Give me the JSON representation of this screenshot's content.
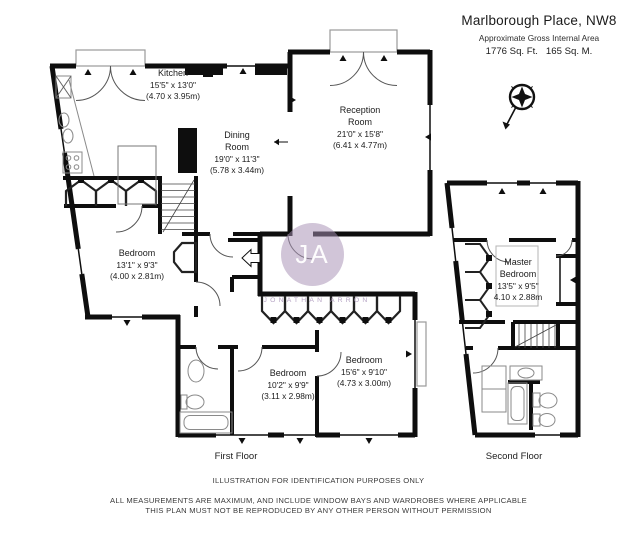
{
  "header": {
    "title": "Marlborough Place, NW8",
    "subtitle": "Approximate Gross Internal Area",
    "area": "1776 Sq. Ft.   165 Sq. M."
  },
  "compass": {
    "icon": "compass-rose"
  },
  "watermark": {
    "initials": "JA",
    "name": "JONATHAN ARRON"
  },
  "floors": [
    {
      "label": "First Floor",
      "rooms": [
        {
          "name": "Kitchen",
          "dims_ft": "15'5\" x 13'0\"",
          "dims_m": "(4.70 x 3.95m)"
        },
        {
          "name": "Dining Room",
          "dims_ft": "19'0\" x 11'3\"",
          "dims_m": "(5.78 x 3.44m)"
        },
        {
          "name": "Reception Room",
          "dims_ft": "21'0\" x 15'8\"",
          "dims_m": "(6.41 x 4.77m)"
        },
        {
          "name": "Bedroom",
          "dims_ft": "13'1\" x 9'3\"",
          "dims_m": "(4.00 x 2.81m)"
        },
        {
          "name": "Bedroom",
          "dims_ft": "10'2\" x 9'9\"",
          "dims_m": "(3.11 x 2.98m)"
        },
        {
          "name": "Bedroom",
          "dims_ft": "15'6\" x 9'10\"",
          "dims_m": "(4.73 x 3.00m)"
        }
      ]
    },
    {
      "label": "Second Floor",
      "rooms": [
        {
          "name": "Master Bedroom",
          "dims_ft": "13'5\" x 9'5\"",
          "dims_m": "4.10 x 2.88m"
        }
      ]
    }
  ],
  "footer": {
    "line1": "ILLUSTRATION FOR IDENTIFICATION PURPOSES ONLY",
    "line2": "ALL MEASUREMENTS ARE MAXIMUM, AND INCLUDE WINDOW BAYS AND WARDROBES WHERE APPLICABLE",
    "line3": "THIS PLAN MUST NOT BE REPRODUCED BY ANY OTHER PERSON WITHOUT PERMISSION"
  },
  "colors": {
    "wall": "#0e0e0e",
    "watermark": "#a790b5",
    "text": "#1c1c1c"
  }
}
